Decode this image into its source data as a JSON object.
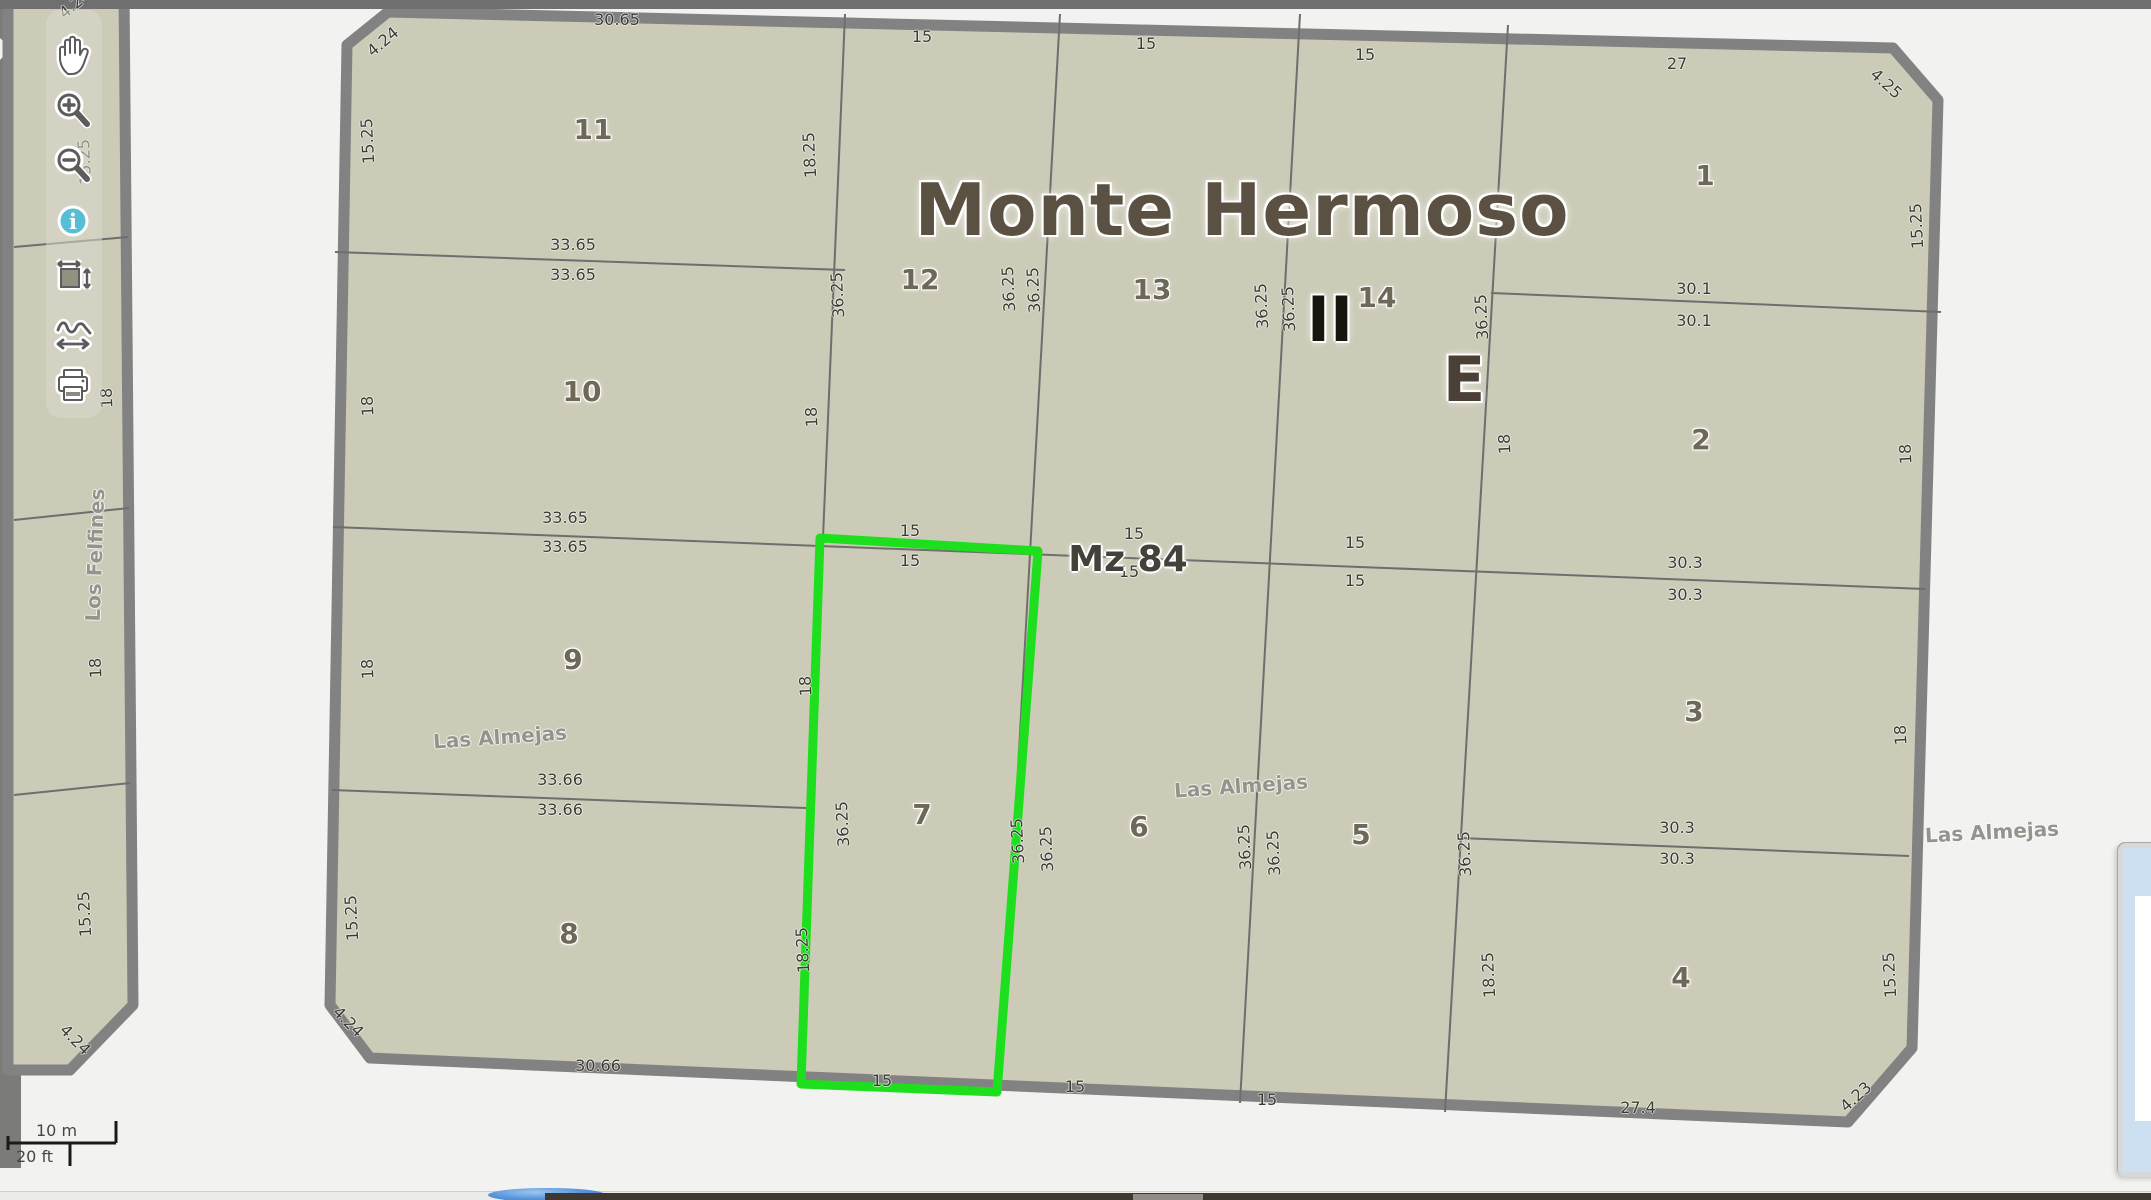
{
  "app": {
    "type": "cadastral-map-viewer"
  },
  "title": "Monte Hermoso",
  "block_label": "Mz 84",
  "zone_markers": [
    "II",
    "E"
  ],
  "streets": [
    "Los Felfines",
    "Las Almejas"
  ],
  "highlighted_parcel": "7",
  "parcel_numbers": [
    "1",
    "2",
    "3",
    "4",
    "5",
    "6",
    "7",
    "8",
    "9",
    "10",
    "11",
    "12",
    "13",
    "14"
  ],
  "scale_bar": {
    "metric": "10 m",
    "imperial": "20 ft"
  },
  "toolbar": {
    "items": [
      {
        "id": "pan",
        "icon": "hand-icon"
      },
      {
        "id": "zoom-in",
        "icon": "magnifier-plus-icon"
      },
      {
        "id": "zoom-out",
        "icon": "magnifier-minus-icon"
      },
      {
        "id": "identify",
        "icon": "info-icon"
      },
      {
        "id": "zoom-extent",
        "icon": "extent-rect-icon"
      },
      {
        "id": "measure-path",
        "icon": "measure-path-icon"
      },
      {
        "id": "print",
        "icon": "printer-icon"
      }
    ]
  },
  "colors": {
    "parcel_fill": "#cccbb8",
    "street_line": "#818181",
    "thin_line": "#6e6e6e",
    "highlight_green": "#1ddf1d",
    "info_blue": "#58bed6",
    "title_brown": "#5b5143",
    "panel_blue": "#cde0f2",
    "footer_dark": "#3e3830"
  },
  "map_labels": [
    {
      "t": "30.65",
      "x": 617,
      "y": 20,
      "k": "dim"
    },
    {
      "t": "15",
      "x": 922,
      "y": 37,
      "k": "dim"
    },
    {
      "t": "15",
      "x": 1146,
      "y": 44,
      "k": "dim"
    },
    {
      "t": "15",
      "x": 1365,
      "y": 55,
      "k": "dim"
    },
    {
      "t": "27",
      "x": 1677,
      "y": 64,
      "k": "dim"
    },
    {
      "t": "33.65",
      "x": 573,
      "y": 245,
      "k": "dim"
    },
    {
      "t": "33.65",
      "x": 573,
      "y": 275,
      "k": "dim"
    },
    {
      "t": "30.1",
      "x": 1694,
      "y": 289,
      "k": "dim"
    },
    {
      "t": "30.1",
      "x": 1694,
      "y": 321,
      "k": "dim"
    },
    {
      "t": "33.65",
      "x": 565,
      "y": 518,
      "k": "dim"
    },
    {
      "t": "33.65",
      "x": 565,
      "y": 547,
      "k": "dim"
    },
    {
      "t": "15",
      "x": 910,
      "y": 531,
      "k": "dim"
    },
    {
      "t": "15",
      "x": 910,
      "y": 561,
      "k": "dim"
    },
    {
      "t": "15",
      "x": 1134,
      "y": 534,
      "k": "dim"
    },
    {
      "t": "15",
      "x": 1129,
      "y": 572,
      "k": "dim"
    },
    {
      "t": "15",
      "x": 1355,
      "y": 543,
      "k": "dim"
    },
    {
      "t": "15",
      "x": 1355,
      "y": 581,
      "k": "dim"
    },
    {
      "t": "30.3",
      "x": 1685,
      "y": 563,
      "k": "dim"
    },
    {
      "t": "30.3",
      "x": 1685,
      "y": 595,
      "k": "dim"
    },
    {
      "t": "33.66",
      "x": 560,
      "y": 780,
      "k": "dim"
    },
    {
      "t": "33.66",
      "x": 560,
      "y": 810,
      "k": "dim"
    },
    {
      "t": "30.3",
      "x": 1677,
      "y": 828,
      "k": "dim"
    },
    {
      "t": "30.3",
      "x": 1677,
      "y": 859,
      "k": "dim"
    },
    {
      "t": "30.66",
      "x": 598,
      "y": 1066,
      "k": "dim"
    },
    {
      "t": "15",
      "x": 882,
      "y": 1081,
      "k": "dim"
    },
    {
      "t": "15",
      "x": 1075,
      "y": 1087,
      "k": "dim"
    },
    {
      "t": "15",
      "x": 1267,
      "y": 1100,
      "k": "dim"
    },
    {
      "t": "27.4",
      "x": 1638,
      "y": 1108,
      "k": "dim"
    },
    {
      "t": "15.25",
      "x": 85,
      "y": 162,
      "k": "dim",
      "r": -93
    },
    {
      "t": "18",
      "x": 107,
      "y": 398,
      "k": "dim",
      "r": -93
    },
    {
      "t": "18",
      "x": 96,
      "y": 668,
      "k": "dim",
      "r": -93
    },
    {
      "t": "15.25",
      "x": 85,
      "y": 914,
      "k": "dim",
      "r": -93
    },
    {
      "t": "15.25",
      "x": 368,
      "y": 141,
      "k": "dim",
      "r": -93
    },
    {
      "t": "18",
      "x": 368,
      "y": 406,
      "k": "dim",
      "r": -93
    },
    {
      "t": "18",
      "x": 368,
      "y": 669,
      "k": "dim",
      "r": -93
    },
    {
      "t": "15.25",
      "x": 352,
      "y": 918,
      "k": "dim",
      "r": -93
    },
    {
      "t": "18.25",
      "x": 810,
      "y": 155,
      "k": "dim",
      "r": -93
    },
    {
      "t": "18",
      "x": 812,
      "y": 417,
      "k": "dim",
      "r": -93
    },
    {
      "t": "18",
      "x": 806,
      "y": 686,
      "k": "dim",
      "r": -93
    },
    {
      "t": "18.25",
      "x": 803,
      "y": 950,
      "k": "dim",
      "r": -93
    },
    {
      "t": "36.25",
      "x": 838,
      "y": 295,
      "k": "dim",
      "r": -93
    },
    {
      "t": "36.25",
      "x": 843,
      "y": 824,
      "k": "dim",
      "r": -93
    },
    {
      "t": "36.25",
      "x": 1009,
      "y": 289,
      "k": "dim",
      "r": -93
    },
    {
      "t": "36.25",
      "x": 1034,
      "y": 290,
      "k": "dim",
      "r": -93
    },
    {
      "t": "36.25",
      "x": 1018,
      "y": 841,
      "k": "dim",
      "r": -93
    },
    {
      "t": "36.25",
      "x": 1047,
      "y": 849,
      "k": "dim",
      "r": -93
    },
    {
      "t": "36.25",
      "x": 1262,
      "y": 306,
      "k": "dim",
      "r": -93
    },
    {
      "t": "36.25",
      "x": 1289,
      "y": 309,
      "k": "dim",
      "r": -93
    },
    {
      "t": "36.25",
      "x": 1245,
      "y": 847,
      "k": "dim",
      "r": -93
    },
    {
      "t": "36.25",
      "x": 1274,
      "y": 853,
      "k": "dim",
      "r": -93
    },
    {
      "t": "36.25",
      "x": 1482,
      "y": 317,
      "k": "dim",
      "r": -93
    },
    {
      "t": "18",
      "x": 1505,
      "y": 444,
      "k": "dim",
      "r": -93
    },
    {
      "t": "36.25",
      "x": 1465,
      "y": 854,
      "k": "dim",
      "r": -93
    },
    {
      "t": "18.25",
      "x": 1489,
      "y": 975,
      "k": "dim",
      "r": -93
    },
    {
      "t": "15.25",
      "x": 1917,
      "y": 226,
      "k": "dim",
      "r": -93
    },
    {
      "t": "18",
      "x": 1906,
      "y": 454,
      "k": "dim",
      "r": -93
    },
    {
      "t": "18",
      "x": 1901,
      "y": 735,
      "k": "dim",
      "r": -93
    },
    {
      "t": "15.25",
      "x": 1890,
      "y": 975,
      "k": "dim",
      "r": -93
    },
    {
      "t": "4.24",
      "x": 75,
      "y": 4,
      "k": "dim",
      "r": -40
    },
    {
      "t": "4.24",
      "x": 383,
      "y": 42,
      "k": "dim",
      "r": -40
    },
    {
      "t": "4.25",
      "x": 1886,
      "y": 84,
      "k": "dim",
      "r": 42
    },
    {
      "t": "4.24",
      "x": 75,
      "y": 1040,
      "k": "dim",
      "r": 45
    },
    {
      "t": "4.24",
      "x": 348,
      "y": 1022,
      "k": "dim",
      "r": 45
    },
    {
      "t": "4.23",
      "x": 1856,
      "y": 1097,
      "k": "dim",
      "r": -42
    },
    {
      "t": "11",
      "x": 593,
      "y": 130,
      "k": "parcel"
    },
    {
      "t": "12",
      "x": 920,
      "y": 280,
      "k": "parcel"
    },
    {
      "t": "13",
      "x": 1152,
      "y": 290,
      "k": "parcel"
    },
    {
      "t": "14",
      "x": 1377,
      "y": 298,
      "k": "parcel"
    },
    {
      "t": "1",
      "x": 1705,
      "y": 176,
      "k": "parcel"
    },
    {
      "t": "2",
      "x": 1701,
      "y": 440,
      "k": "parcel"
    },
    {
      "t": "3",
      "x": 1694,
      "y": 712,
      "k": "parcel"
    },
    {
      "t": "4",
      "x": 1681,
      "y": 978,
      "k": "parcel"
    },
    {
      "t": "10",
      "x": 582,
      "y": 392,
      "k": "parcel"
    },
    {
      "t": "9",
      "x": 573,
      "y": 660,
      "k": "parcel"
    },
    {
      "t": "8",
      "x": 569,
      "y": 934,
      "k": "parcel"
    },
    {
      "t": "7",
      "x": 922,
      "y": 815,
      "k": "parcel"
    },
    {
      "t": "6",
      "x": 1139,
      "y": 827,
      "k": "parcel"
    },
    {
      "t": "5",
      "x": 1361,
      "y": 835,
      "k": "parcel"
    },
    {
      "t": "Monte Hermoso",
      "x": 1242,
      "y": 210,
      "k": "title",
      "n": "map-title"
    },
    {
      "t": "Mz 84",
      "x": 1128,
      "y": 560,
      "k": "block",
      "n": "block-label"
    },
    {
      "t": "II",
      "x": 1330,
      "y": 320,
      "k": "zone",
      "n": "zone-marker-II"
    },
    {
      "t": "E",
      "x": 1464,
      "y": 380,
      "k": "zone",
      "n": "zone-marker-E",
      "c": "#4a4036"
    },
    {
      "t": "Los Felfines",
      "x": 95,
      "y": 555,
      "k": "street",
      "r": -88,
      "n": "street-label-los-felfines"
    },
    {
      "t": "Las Almejas",
      "x": 500,
      "y": 737,
      "k": "street",
      "r": -4,
      "n": "street-label-las-almejas-west"
    },
    {
      "t": "Las Almejas",
      "x": 1241,
      "y": 786,
      "k": "street",
      "r": -4,
      "n": "street-label-las-almejas-mid"
    },
    {
      "t": "Las Almejas",
      "x": 1992,
      "y": 832,
      "k": "street",
      "r": -3,
      "n": "street-label-las-almejas-east"
    }
  ]
}
